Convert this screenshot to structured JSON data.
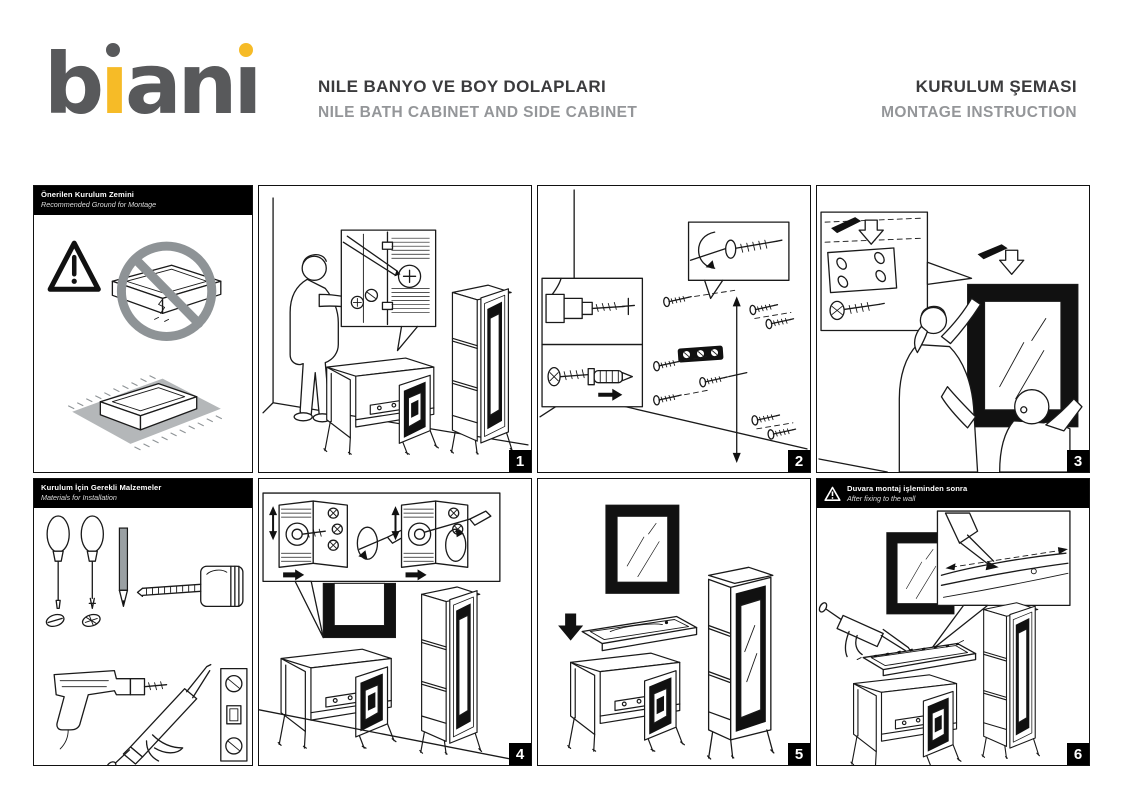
{
  "page": {
    "width": 1123,
    "height": 794,
    "background": "#ffffff"
  },
  "colors": {
    "brand_gray": "#58595b",
    "brand_yellow": "#f6bb27",
    "title_dark": "#3b3b3d",
    "title_gray": "#949699",
    "panel_border": "#111111",
    "header_bar": "#000000",
    "prohibition_gray": "#8e9396",
    "carpet_gray": "#b4b7b9"
  },
  "logo": {
    "text": "biani",
    "l1": "b",
    "l2": "ı",
    "l3": "a",
    "l4": "n",
    "l5": "ı"
  },
  "header": {
    "product_title": "NILE BANYO VE BOY DOLAPLARI",
    "product_subtitle": "NILE BATH CABINET AND SIDE CABINET",
    "doc_title": "KURULUM ŞEMASI",
    "doc_subtitle": "MONTAGE INSTRUCTION"
  },
  "panels": {
    "ground": {
      "title": "Önerilen Kurulum Zemini",
      "subtitle": "Recommended Ground for Montage",
      "icons": [
        "warning-triangle-icon",
        "no-uneven-floor-icon",
        "carpet-underlay-icon"
      ]
    },
    "materials": {
      "title": "Kurulum İçin Gerekli Malzemeler",
      "subtitle": "Materials for Installation",
      "tools": [
        "flat-screwdriver-icon",
        "phillips-screwdriver-icon",
        "pencil-icon",
        "tape-measure-icon",
        "drill-icon",
        "silicone-gun-icon",
        "spirit-level-icon"
      ]
    }
  },
  "steps": [
    {
      "number": "1",
      "scene": "mark-wall-through-cabinet"
    },
    {
      "number": "2",
      "scene": "drill-wall-insert-dowels-fix-bracket"
    },
    {
      "number": "3",
      "scene": "hang-mirror-on-wall"
    },
    {
      "number": "4",
      "scene": "adjust-hanging-brackets"
    },
    {
      "number": "5",
      "scene": "place-washbasin-on-cabinet"
    },
    {
      "number": "6",
      "scene": "apply-silicone-sealant",
      "warning_title": "Duvara montaj işleminden sonra",
      "warning_subtitle": "After fixing to the wall"
    }
  ]
}
